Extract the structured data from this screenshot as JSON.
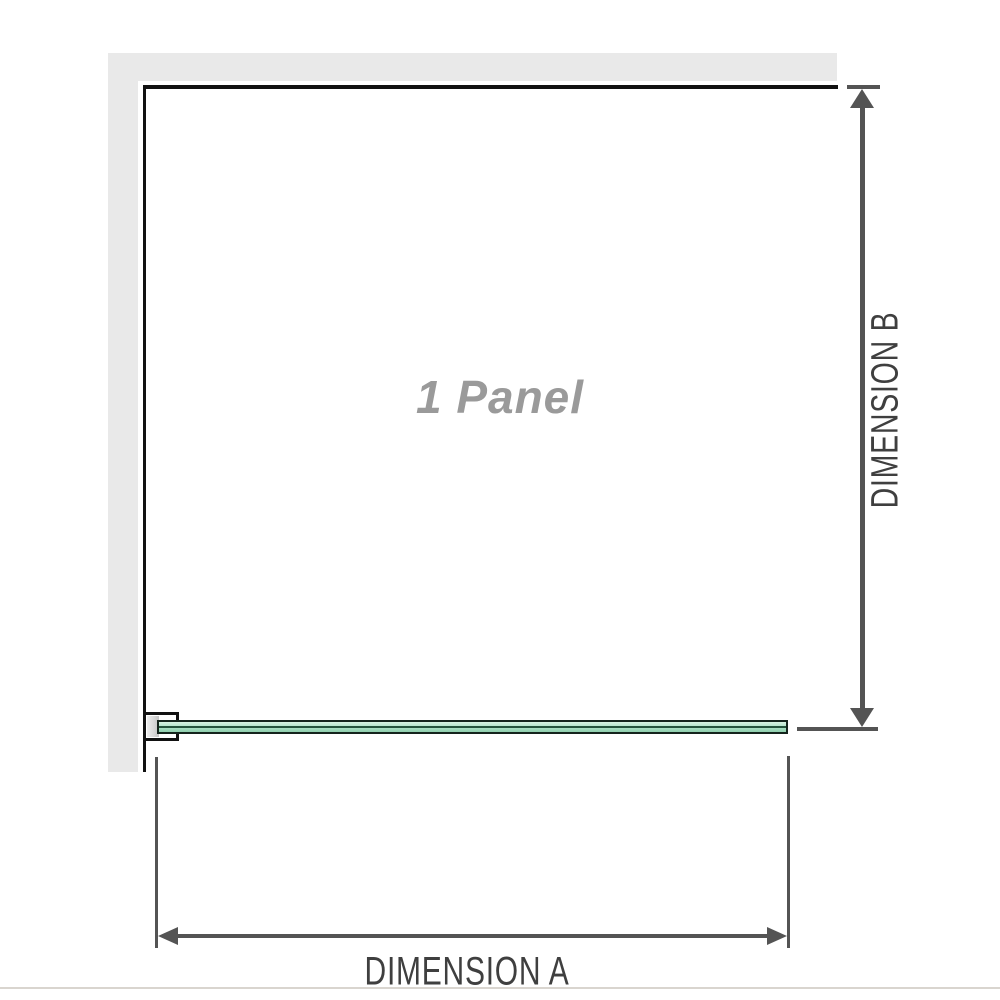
{
  "labels": {
    "panel": "1 Panel",
    "dimension_a": "DIMENSION A",
    "dimension_b": "DIMENSION B"
  },
  "colors": {
    "wall": "#e9e9e9",
    "outline": "#111111",
    "dimension": "#545454",
    "dim_label": "#3f3f3f",
    "panel_label": "#9a9a9a",
    "glass_light": "#d8f2e3",
    "glass_dark": "#8fcfae",
    "glass_core": "#24533c",
    "border_bottom": "#d9d5cf"
  }
}
